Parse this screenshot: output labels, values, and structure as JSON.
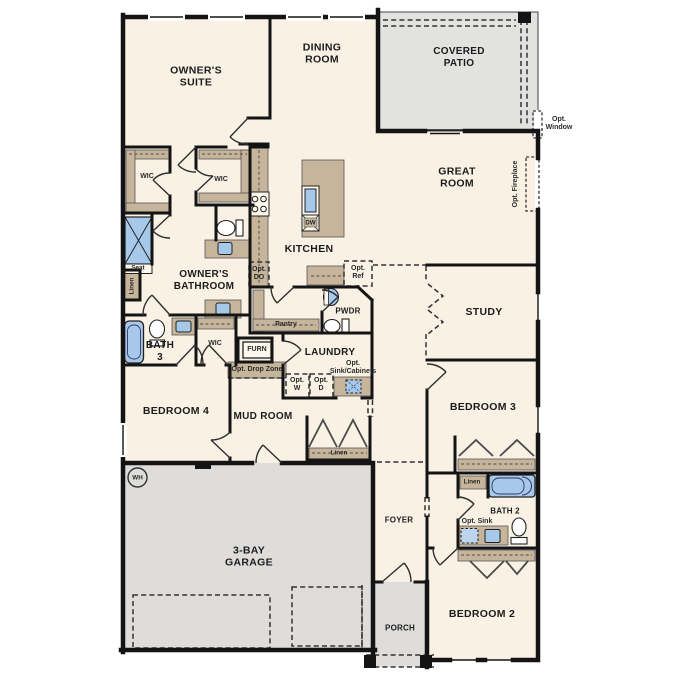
{
  "floorplan": {
    "rooms": {
      "owners_suite": "OWNER'S SUITE",
      "dining_room": "DINING ROOM",
      "covered_patio": "COVERED PATIO",
      "great_room": "GREAT ROOM",
      "kitchen": "KITCHEN",
      "study": "STUDY",
      "owners_bathroom": "OWNER'S BATHROOM",
      "bath_3": "BATH 3",
      "bedroom_4": "BEDROOM 4",
      "mud_room": "MUD ROOM",
      "laundry": "LAUNDRY",
      "pwdr": "PWDR",
      "pantry": "Pantry",
      "bedroom_3": "BEDROOM 3",
      "foyer": "FOYER",
      "bath_2": "BATH 2",
      "bedroom_2": "BEDROOM 2",
      "garage": "3-BAY GARAGE",
      "porch": "PORCH"
    },
    "closets": {
      "wic": "WIC",
      "linen": "Linen",
      "seat": "Seat",
      "furn": "FURN"
    },
    "appliances": {
      "dw": "DW",
      "wh": "WH"
    },
    "options": {
      "opt_window": "Opt. Window",
      "opt_fireplace": "Opt. Fireplace",
      "opt_do": "Opt. DO",
      "opt_ref": "Opt. Ref",
      "opt_drop_zone": "Opt. Drop Zone",
      "opt_w": "Opt. W",
      "opt_d": "Opt. D",
      "opt_sink_cabinets": "Opt. Sink/Cabinets",
      "opt_sink": "Opt. Sink"
    },
    "colors": {
      "floor": "#f9f1e4",
      "hardscape": "#e2e2e0",
      "cabinet": "#c6b59b",
      "fixture_blue": "#a7c9e9",
      "wall": "#141414"
    }
  }
}
